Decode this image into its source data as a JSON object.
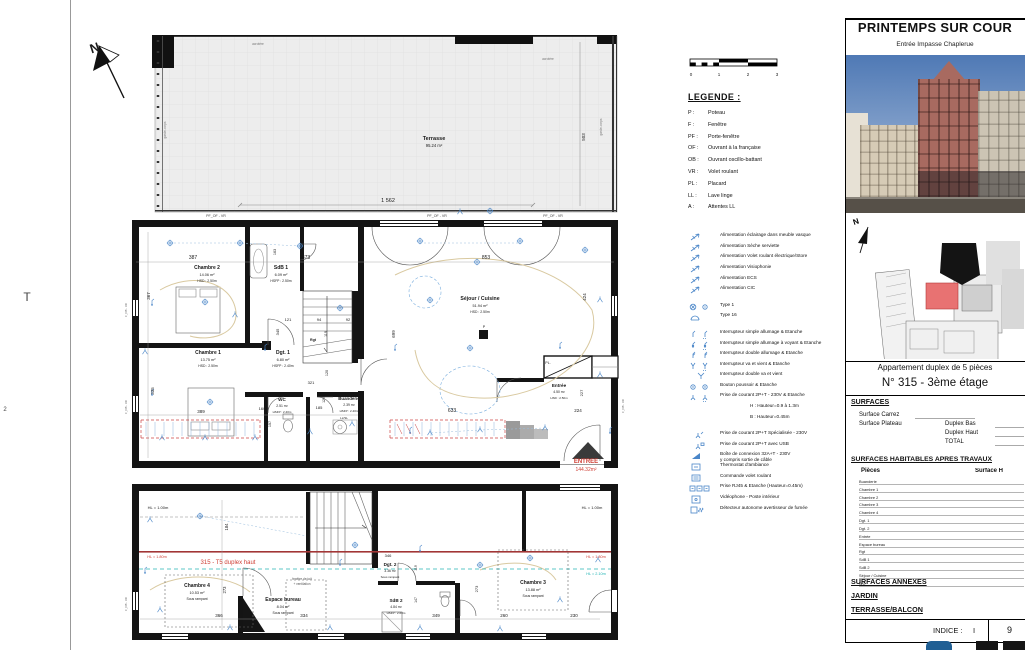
{
  "sheet": {
    "stray_t": "T",
    "stray_2": "2"
  },
  "legend": {
    "title": "LEGENDE :",
    "abbr": [
      [
        "P :",
        "Poteau"
      ],
      [
        "F :",
        "Fenêtre"
      ],
      [
        "PF :",
        "Porte-fenêtre"
      ],
      [
        "OF :",
        "Ouvrant à la française"
      ],
      [
        "OB :",
        "Ouvrant oscillo-battant"
      ],
      [
        "VR :",
        "Volet roulant"
      ],
      [
        "PL :",
        "Placard"
      ],
      [
        "LL :",
        "Lave linge"
      ],
      [
        "A :",
        "Attentes LL"
      ]
    ],
    "electro": [
      {
        "icon": "arrow",
        "label": "Alimentation éclairage dans meuble vasque"
      },
      {
        "icon": "arrow",
        "label": "Alimentation Sèche serviette"
      },
      {
        "icon": "arrow",
        "label": "Alimentation Volet roulant électrique/Store"
      },
      {
        "icon": "arrow",
        "label": "Alimentation Visiophonie"
      },
      {
        "icon": "arrow",
        "label": "Alimentation ECS"
      },
      {
        "icon": "arrow",
        "label": "Alimentation CIC"
      },
      {
        "icon": "type1",
        "label": "Type 1",
        "gap": true
      },
      {
        "icon": "type16",
        "label": "Type 16"
      },
      {
        "icon": "int1",
        "label": "Interrupteur simple allumage & Etanche",
        "gap": true
      },
      {
        "icon": "int1v",
        "label": "Interrupteur simple allumage à voyant & Etanche"
      },
      {
        "icon": "int2",
        "label": "Interrupteur double allumage & Etanche"
      },
      {
        "icon": "vv",
        "label": "Interrupteur va et vient & Etanche"
      },
      {
        "icon": "dvv",
        "label": "Interrupteur double va et vient"
      },
      {
        "icon": "bp",
        "label": "Bouton poussoir & Etanche"
      },
      {
        "icon": "prise",
        "label": "Prise de courant 2P+T - 230V & Etanche"
      },
      {
        "indent": true,
        "label": "H : Hauteur=0.9 à 1.3m"
      },
      {
        "indent": true,
        "label": "B : Hauteur=0.45m"
      },
      {
        "icon": "priseS",
        "label": "Prise de courant 2P+T Spécialisée - 230V",
        "gap": true
      },
      {
        "icon": "usb",
        "label": "Prise de courant 2P+T avec USB"
      },
      {
        "icon": "boite",
        "label": "Boîte de connexion 32A+T - 230V",
        "line2": "y compris sortie de câble"
      },
      {
        "icon": "thermo",
        "label": "Thermostat d'ambiance"
      },
      {
        "icon": "cvr",
        "label": "Commande volet roulant"
      },
      {
        "icon": "rj45",
        "label": "Prise RJ45 & Etanche (Hauteur=0.45m)"
      },
      {
        "icon": "video",
        "label": "Vidéophone - Poste intérieur"
      },
      {
        "icon": "fumee",
        "label": "Détecteur autonome avertisseur de fumée"
      }
    ]
  },
  "titleblock": {
    "title": "PRINTEMPS SUR COUR",
    "subtitle": "Entrée Impasse Chaplerue",
    "site_north": "N",
    "apt_type": "Appartement duplex de 5 pièces",
    "apt_num": "N° 315 - 3ème étage",
    "surfaces_h": "SURFACES",
    "carrez": "Surface Carrez",
    "plateau": "Surface Plateau",
    "duplex_bas": "Duplex Bas",
    "duplex_haut": "Duplex Haut",
    "total": "TOTAL",
    "habitables_h": "SURFACES HABITABLES APRES TRAVAUX",
    "col_pieces": "Pièces",
    "col_surface": "Surface H",
    "rooms": [
      "Buanderie",
      "Chambre 1",
      "Chambre 2",
      "Chambre 3",
      "Chambre 4",
      "Dgt. 1",
      "Dgt. 2",
      "Entrée",
      "Espace bureau",
      "Rgt",
      "SdB 1",
      "SdB 2",
      "Séjour / Cuisine",
      "WC"
    ],
    "annexes_h": "SURFACES ANNEXES",
    "jardin": "JARDIN",
    "terrasse": "TERRASSE/BALCON",
    "indice_label": "INDICE :",
    "indice_value": "I",
    "page": "9"
  },
  "colors": {
    "electric_blue": "#4a86c8",
    "plan_red": "#cf3f35",
    "plan_teal": "#1fb3b3",
    "site_red": "#e87272"
  },
  "plan_labels": [
    {
      "t": "T",
      "x": 27,
      "y": 301,
      "s": 12,
      "c": "#444"
    },
    {
      "t": "2",
      "x": 5,
      "y": 411,
      "s": 6,
      "c": "#444"
    },
    {
      "t": "N",
      "x": 96,
      "y": 52,
      "s": 13,
      "b": 1,
      "r": -18,
      "n": "north-letter"
    },
    {
      "t": "Terrasse",
      "x": 434,
      "y": 140,
      "s": 5.5,
      "b": 1
    },
    {
      "t": "95.24 m²",
      "x": 434,
      "y": 147,
      "s": 4.2
    },
    {
      "t": "1 562",
      "x": 388,
      "y": 202,
      "s": 5.5
    },
    {
      "t": "503",
      "x": 585,
      "y": 137,
      "s": 4.5,
      "r": -90
    },
    {
      "t": "acrotère",
      "x": 258,
      "y": 45,
      "s": 3.2,
      "c": "#777"
    },
    {
      "t": "acrotère",
      "x": 548,
      "y": 60,
      "s": 3.2,
      "c": "#777"
    },
    {
      "t": "garde-corps",
      "x": 166,
      "y": 130,
      "s": 3.2,
      "c": "#777",
      "r": -90
    },
    {
      "t": "garde-corps",
      "x": 602,
      "y": 127,
      "s": 3.2,
      "c": "#777",
      "r": -90
    },
    {
      "t": "PF_OF - VR",
      "x": 216,
      "y": 217,
      "s": 3.6,
      "c": "#444"
    },
    {
      "t": "PF_OF - VR",
      "x": 437,
      "y": 217,
      "s": 3.6,
      "c": "#444"
    },
    {
      "t": "PF_OF - VR",
      "x": 553,
      "y": 217,
      "s": 3.6,
      "c": "#444"
    },
    {
      "t": "387",
      "x": 193,
      "y": 259,
      "s": 5
    },
    {
      "t": "373",
      "x": 306,
      "y": 259,
      "s": 5
    },
    {
      "t": "853",
      "x": 486,
      "y": 259,
      "s": 5
    },
    {
      "t": "163",
      "x": 276,
      "y": 252,
      "s": 3.8,
      "r": -90
    },
    {
      "t": "367",
      "x": 150,
      "y": 296,
      "s": 4.5,
      "r": -90
    },
    {
      "t": "335",
      "x": 154,
      "y": 391,
      "s": 4.5,
      "r": -90
    },
    {
      "t": "389",
      "x": 201,
      "y": 413,
      "s": 4.5
    },
    {
      "t": "345",
      "x": 279,
      "y": 332,
      "s": 4,
      "r": -90
    },
    {
      "t": "121",
      "x": 288,
      "y": 321,
      "s": 4
    },
    {
      "t": "94",
      "x": 319,
      "y": 321,
      "s": 4
    },
    {
      "t": "92",
      "x": 348,
      "y": 321,
      "s": 4
    },
    {
      "t": "119",
      "x": 327,
      "y": 334,
      "s": 3.8,
      "r": -90
    },
    {
      "t": "120",
      "x": 328,
      "y": 373,
      "s": 3.8,
      "r": -90
    },
    {
      "t": "321",
      "x": 311,
      "y": 384,
      "s": 4
    },
    {
      "t": "185",
      "x": 319,
      "y": 409,
      "s": 4
    },
    {
      "t": "160",
      "x": 262,
      "y": 410,
      "s": 4
    },
    {
      "t": "157",
      "x": 271,
      "y": 424,
      "s": 3.8,
      "r": -90
    },
    {
      "t": "129",
      "x": 325,
      "y": 400,
      "s": 3.5,
      "r": -90
    },
    {
      "t": "699",
      "x": 395,
      "y": 334,
      "s": 4.5,
      "r": -90
    },
    {
      "t": "424",
      "x": 586,
      "y": 297,
      "s": 4.5,
      "r": -90
    },
    {
      "t": "633",
      "x": 452,
      "y": 412,
      "s": 5
    },
    {
      "t": "224",
      "x": 578,
      "y": 412,
      "s": 4.5
    },
    {
      "t": "227",
      "x": 583,
      "y": 393,
      "s": 4,
      "r": -90
    },
    {
      "t": "Chambre 2",
      "x": 207,
      "y": 269,
      "s": 5,
      "b": 1
    },
    {
      "t": "14.06 m²",
      "x": 207,
      "y": 276,
      "s": 3.8
    },
    {
      "t": "HSD : 2.50m",
      "x": 207,
      "y": 282,
      "s": 3.4
    },
    {
      "t": "SdB 1",
      "x": 281,
      "y": 269,
      "s": 5,
      "b": 1
    },
    {
      "t": "6.09 m²",
      "x": 281,
      "y": 276,
      "s": 3.8
    },
    {
      "t": "HSFP : 2.50m",
      "x": 281,
      "y": 282,
      "s": 3.4
    },
    {
      "t": "Chambre 1",
      "x": 208,
      "y": 354,
      "s": 5,
      "b": 1
    },
    {
      "t": "13.75 m²",
      "x": 208,
      "y": 361,
      "s": 3.8
    },
    {
      "t": "HSD : 2.50m",
      "x": 208,
      "y": 367,
      "s": 3.4
    },
    {
      "t": "Dgt. 1",
      "x": 283,
      "y": 354,
      "s": 5,
      "b": 1
    },
    {
      "t": "6.80 m²",
      "x": 283,
      "y": 361,
      "s": 3.8
    },
    {
      "t": "HSFP : 2.40m",
      "x": 283,
      "y": 367,
      "s": 3.4
    },
    {
      "t": "Rgt",
      "x": 313,
      "y": 341,
      "s": 3.6,
      "b": 1
    },
    {
      "t": "WC",
      "x": 282,
      "y": 401,
      "s": 4.6,
      "b": 1
    },
    {
      "t": "2.51 m²",
      "x": 282,
      "y": 407,
      "s": 3.4
    },
    {
      "t": "HSFP : 2.40m",
      "x": 282,
      "y": 413,
      "s": 3
    },
    {
      "t": "Buanderie",
      "x": 349,
      "y": 400,
      "s": 4.4,
      "b": 1
    },
    {
      "t": "2.39 m²",
      "x": 349,
      "y": 406,
      "s": 3.4
    },
    {
      "t": "HSFP : 2.40m",
      "x": 349,
      "y": 412,
      "s": 3
    },
    {
      "t": "LL/SL",
      "x": 344,
      "y": 419,
      "s": 3
    },
    {
      "t": "Séjour / Cuisine",
      "x": 480,
      "y": 300,
      "s": 5.2,
      "b": 1
    },
    {
      "t": "51.94 m²",
      "x": 480,
      "y": 307,
      "s": 3.8
    },
    {
      "t": "HSD : 2.50m",
      "x": 480,
      "y": 313,
      "s": 3.4
    },
    {
      "t": "P",
      "x": 484,
      "y": 328,
      "s": 3.6
    },
    {
      "t": "PL.",
      "x": 548,
      "y": 364,
      "s": 3.6
    },
    {
      "t": "Entrée",
      "x": 559,
      "y": 387,
      "s": 4.6,
      "b": 1
    },
    {
      "t": "4.50 m²",
      "x": 559,
      "y": 393,
      "s": 3.4
    },
    {
      "t": "HSD : 2.50m",
      "x": 559,
      "y": 399,
      "s": 3
    },
    {
      "t": "ENTREE",
      "x": 586,
      "y": 463,
      "s": 6,
      "b": 1,
      "c": "#cf3f35",
      "n": "entry-label"
    },
    {
      "t": "144.32m²",
      "x": 586,
      "y": 471,
      "s": 5,
      "c": "#cf3f35"
    },
    {
      "t": "F_OB - VR",
      "x": 127,
      "y": 310,
      "s": 2.8,
      "c": "#666",
      "r": -90
    },
    {
      "t": "F_OB - VR",
      "x": 127,
      "y": 407,
      "s": 2.8,
      "c": "#666",
      "r": -90
    },
    {
      "t": "F_OB - VR",
      "x": 127,
      "y": 604,
      "s": 2.8,
      "c": "#666",
      "r": -90
    },
    {
      "t": "F_OB - VR",
      "x": 624,
      "y": 406,
      "s": 2.8,
      "c": "#666",
      "r": -90
    },
    {
      "t": "HL = 1.00m",
      "x": 158,
      "y": 509,
      "s": 4
    },
    {
      "t": "HL = 1.00m",
      "x": 592,
      "y": 509,
      "s": 4
    },
    {
      "t": "HL = 1.80m",
      "x": 157,
      "y": 558,
      "s": 3.8,
      "c": "#cf3f35"
    },
    {
      "t": "HL = 1.80m",
      "x": 596,
      "y": 558,
      "s": 3.8,
      "c": "#cf3f35"
    },
    {
      "t": "HL = 2.10m",
      "x": 596,
      "y": 575,
      "s": 3.8,
      "c": "#1fb3b3"
    },
    {
      "t": "315 - T5 duplex haut",
      "x": 228,
      "y": 564,
      "s": 6,
      "c": "#cf3f35",
      "n": "unit-label"
    },
    {
      "t": "184",
      "x": 228,
      "y": 527,
      "s": 4.2,
      "r": -90
    },
    {
      "t": "Chambre 4",
      "x": 197,
      "y": 587,
      "s": 5,
      "b": 1
    },
    {
      "t": "10.53 m²",
      "x": 197,
      "y": 594,
      "s": 3.8
    },
    {
      "t": "Sous rampant",
      "x": 197,
      "y": 600,
      "s": 3.4
    },
    {
      "t": "273",
      "x": 226,
      "y": 590,
      "s": 4.2,
      "r": -90
    },
    {
      "t": "366",
      "x": 219,
      "y": 617,
      "s": 4.5
    },
    {
      "t": "Espace bureau",
      "x": 283,
      "y": 601,
      "s": 5,
      "b": 1
    },
    {
      "t": "8.04 m²",
      "x": 283,
      "y": 608,
      "s": 3.8
    },
    {
      "t": "Sous rampant",
      "x": 283,
      "y": 614,
      "s": 3.4
    },
    {
      "t": "334",
      "x": 304,
      "y": 617,
      "s": 4.5
    },
    {
      "t": "fenêtre de toit",
      "x": 302,
      "y": 580,
      "s": 3.2,
      "c": "#555"
    },
    {
      "t": "+ ventilation",
      "x": 302,
      "y": 585,
      "s": 3.2,
      "c": "#555"
    },
    {
      "t": "Dgt. 2",
      "x": 390,
      "y": 566,
      "s": 4.6,
      "b": 1
    },
    {
      "t": "3.36 m²",
      "x": 390,
      "y": 572,
      "s": 3.4
    },
    {
      "t": "Sous rampant",
      "x": 390,
      "y": 578,
      "s": 3
    },
    {
      "t": "346",
      "x": 388,
      "y": 557,
      "s": 4
    },
    {
      "t": "119",
      "x": 417,
      "y": 568,
      "s": 3.5,
      "r": -90
    },
    {
      "t": "SdB 2",
      "x": 396,
      "y": 602,
      "s": 4.6,
      "b": 1
    },
    {
      "t": "4.84 m²",
      "x": 396,
      "y": 608,
      "s": 3.4
    },
    {
      "t": "HSFP : 2.60m",
      "x": 396,
      "y": 614,
      "s": 3
    },
    {
      "t": "349",
      "x": 436,
      "y": 617,
      "s": 4.5
    },
    {
      "t": "147",
      "x": 417,
      "y": 600,
      "s": 3.5,
      "r": -90
    },
    {
      "t": "Chambre 3",
      "x": 533,
      "y": 584,
      "s": 5,
      "b": 1
    },
    {
      "t": "13.88 m²",
      "x": 533,
      "y": 591,
      "s": 3.8
    },
    {
      "t": "Sous rampant",
      "x": 533,
      "y": 597,
      "s": 3.4
    },
    {
      "t": "273",
      "x": 478,
      "y": 589,
      "s": 4,
      "r": -90
    },
    {
      "t": "260",
      "x": 504,
      "y": 617,
      "s": 4.5
    },
    {
      "t": "230",
      "x": 574,
      "y": 617,
      "s": 4.5
    },
    {
      "t": "0",
      "x": 691,
      "y": 76,
      "s": 4.5
    },
    {
      "t": "1",
      "x": 719,
      "y": 76,
      "s": 4.5
    },
    {
      "t": "2",
      "x": 748,
      "y": 76,
      "s": 4.5
    },
    {
      "t": "3",
      "x": 777,
      "y": 76,
      "s": 4.5
    }
  ],
  "symbols": [
    {
      "x": 170,
      "y": 243,
      "t": "sp"
    },
    {
      "x": 240,
      "y": 243,
      "t": "sp"
    },
    {
      "x": 300,
      "y": 246,
      "t": "sp"
    },
    {
      "x": 420,
      "y": 241,
      "t": "sp"
    },
    {
      "x": 520,
      "y": 241,
      "t": "sp"
    },
    {
      "x": 585,
      "y": 250,
      "t": "sp"
    },
    {
      "x": 477,
      "y": 262,
      "t": "sp"
    },
    {
      "x": 340,
      "y": 308,
      "t": "sp"
    },
    {
      "x": 430,
      "y": 300,
      "t": "sp"
    },
    {
      "x": 205,
      "y": 302,
      "t": "sp"
    },
    {
      "x": 210,
      "y": 402,
      "t": "sp"
    },
    {
      "x": 470,
      "y": 348,
      "t": "sp"
    },
    {
      "x": 152,
      "y": 302,
      "t": "sw"
    },
    {
      "x": 152,
      "y": 392,
      "t": "sw"
    },
    {
      "x": 265,
      "y": 347,
      "t": "sw"
    },
    {
      "x": 395,
      "y": 347,
      "t": "sw"
    },
    {
      "x": 560,
      "y": 345,
      "t": "sw"
    },
    {
      "x": 410,
      "y": 430,
      "t": "sw"
    },
    {
      "x": 610,
      "y": 430,
      "t": "sw"
    },
    {
      "x": 235,
      "y": 315,
      "t": "out"
    },
    {
      "x": 600,
      "y": 300,
      "t": "out"
    },
    {
      "x": 600,
      "y": 375,
      "t": "out"
    },
    {
      "x": 545,
      "y": 428,
      "t": "out"
    },
    {
      "x": 480,
      "y": 430,
      "t": "out"
    },
    {
      "x": 430,
      "y": 433,
      "t": "out"
    },
    {
      "x": 310,
      "y": 432,
      "t": "out"
    },
    {
      "x": 255,
      "y": 438,
      "t": "out"
    },
    {
      "x": 205,
      "y": 438,
      "t": "out"
    },
    {
      "x": 162,
      "y": 438,
      "t": "out"
    },
    {
      "x": 145,
      "y": 352,
      "t": "out"
    },
    {
      "x": 352,
      "y": 424,
      "t": "out"
    },
    {
      "x": 460,
      "y": 212,
      "t": "out"
    },
    {
      "x": 490,
      "y": 211,
      "t": "sp"
    },
    {
      "x": 150,
      "y": 520,
      "t": "out"
    },
    {
      "x": 200,
      "y": 516,
      "t": "sp"
    },
    {
      "x": 355,
      "y": 545,
      "t": "sp"
    },
    {
      "x": 340,
      "y": 562,
      "t": "sw"
    },
    {
      "x": 420,
      "y": 548,
      "t": "sw"
    },
    {
      "x": 530,
      "y": 558,
      "t": "sp"
    },
    {
      "x": 560,
      "y": 600,
      "t": "out"
    },
    {
      "x": 500,
      "y": 629,
      "t": "out"
    },
    {
      "x": 420,
      "y": 628,
      "t": "out"
    },
    {
      "x": 330,
      "y": 628,
      "t": "out"
    },
    {
      "x": 230,
      "y": 628,
      "t": "out"
    },
    {
      "x": 160,
      "y": 610,
      "t": "out"
    },
    {
      "x": 145,
      "y": 570,
      "t": "sw"
    },
    {
      "x": 480,
      "y": 565,
      "t": "sp"
    },
    {
      "x": 598,
      "y": 560,
      "t": "out"
    }
  ]
}
